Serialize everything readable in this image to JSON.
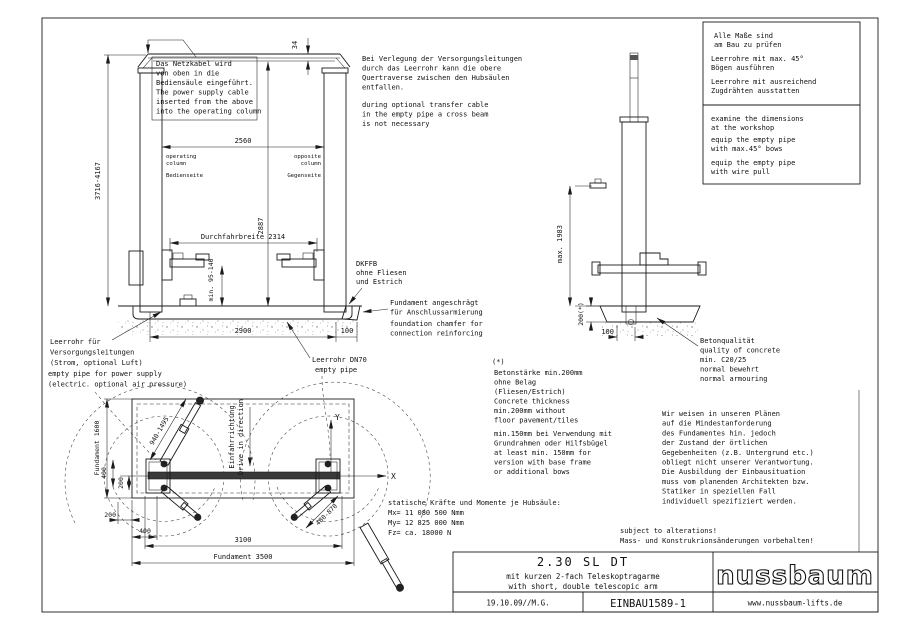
{
  "colors": {
    "line": "#1a1a1a",
    "column_fill": "#e8e8e8",
    "bar_fill": "#3a3a3a",
    "background": "#ffffff"
  },
  "front_view": {
    "cable_note": [
      "Das Netzkabel wird",
      "von oben in die",
      "Bediensäule eingeführt.",
      "The power supply cable",
      "inserted from the above",
      "into the operating column"
    ],
    "dim_beam_offset": "34",
    "dim_column_spacing": "2560",
    "operating_column": [
      "operating",
      "column",
      "Bedienseite"
    ],
    "opposite_column": [
      "opposite",
      "column",
      "Gegenseite"
    ],
    "dim_total_height": "3716-4167",
    "dim_clear_height": "2887",
    "dim_drive_width": "Durchfahrbreite 2314",
    "dim_pad_height": "min. 95-140",
    "dkffb_note": [
      "DKFFB",
      "ohne Fliesen",
      "und Estrich"
    ],
    "dim_foundation_width": "2900",
    "dim_edge_offset": "100",
    "chamfer_note": [
      "Fundament angeschrägt",
      "für Anschlussarmierung",
      "foundation chamfer for",
      "connection reinforcing"
    ],
    "supply_pipe_note": [
      "Leerrohr für",
      "Versorgungsleitungen",
      "(Strom, optional Luft)",
      "empty pipe for power supply",
      "(electric. optional air pressure)"
    ],
    "dn70_pipe_note": [
      "Leerrohr DN70",
      "empty pipe"
    ]
  },
  "crossbeam_note": {
    "de": [
      "Bei Verlegung der Versorgungsleitungen",
      "durch das Leerrohr kann die obere",
      "Quertraverse zwischen den Hubsäulen",
      "entfallen."
    ],
    "en": [
      "during optional transfer cable",
      "in the empty pipe a cross beam",
      "is not necessary"
    ]
  },
  "info_box": {
    "de": [
      "Alle Maße sind",
      "am Bau zu prüfen",
      "Leerrohre mit max. 45°",
      "Bögen ausführen",
      "Leerrohre mit ausreichend",
      "Zugdrähten ausstatten"
    ],
    "en": [
      "examine the dimensions",
      "at the workshop",
      "equip the empty pipe",
      "with max.45° bows",
      "equip the empty pipe",
      "with wire pull"
    ]
  },
  "side_view": {
    "dim_max_height": "max. 1983",
    "dim_slab_depth": "200(*)",
    "dim_pipe_offset": "100",
    "concrete_note": [
      "Betonqualität",
      "quality of concrete",
      "min. C20/25",
      "normal bewehrt",
      "normal armouring"
    ]
  },
  "thickness_note": {
    "marker": "(*)",
    "block1": [
      "Betonstärke min.200mm",
      "ohne Belag",
      "(Fliesen/Estrich)",
      "Concrete thickness",
      "min.200mm without",
      "floor pavement/tiles"
    ],
    "block2": [
      "min.150mm bei Verwendung mit",
      "Grundrahmen oder Hilfsbügel",
      "at least min. 150mm for",
      "version with base frame",
      "or additional bows"
    ]
  },
  "responsibility_note": [
    "Wir weisen in unseren Plänen",
    "auf die Mindestanforderung",
    "des Fundamentes hin.  jedoch",
    "der Zustand der örtlichen",
    "Gegebenheiten (z.B. Untergrund etc.)",
    "obliegt nicht unserer Verantwortung.",
    "Die Ausbildung der Einbausituation",
    "muss vom planenden Architekten bzw.",
    "Statiker in speziellen Fall",
    "individuell spezifiziert werden."
  ],
  "plan_view": {
    "dim_foundation_depth": "Fundament 1600",
    "dim_long_arm": "940-1495",
    "dim_short_arm": "480-870",
    "drive_direction_de": "Einfahrrichtung",
    "drive_direction_en": "Drive in direction",
    "axis_x": "X",
    "axis_y": "Y",
    "dim_plate_v400": "400",
    "dim_plate_v200": "200",
    "dim_edge_h200": "200",
    "dim_edge_h400": "400",
    "dim_column_distance": "3100",
    "dim_foundation_width": "Fundament 3500"
  },
  "forces_note": [
    "statische Kräfte und Momente je Hubsäule:",
    "Mx= 11 080 500 Nmm",
    "My= 12 825 000 Nmm",
    "Fz= ca. 18000 N"
  ],
  "alterations_note": [
    "subject to alterations!",
    "Mass- und Konstrukrionsänderungen vorbehalten!"
  ],
  "title_block": {
    "model": "2.30 SL DT",
    "subtitle_de": "mit kurzen 2-fach Teleskoptragarme",
    "subtitle_en": "with short, double telescopic arm",
    "date_author": "19.10.09//M.G.",
    "drawing_number": "EINBAU1589-1",
    "brand": "nussbaum",
    "website": "www.nussbaum-lifts.de"
  }
}
